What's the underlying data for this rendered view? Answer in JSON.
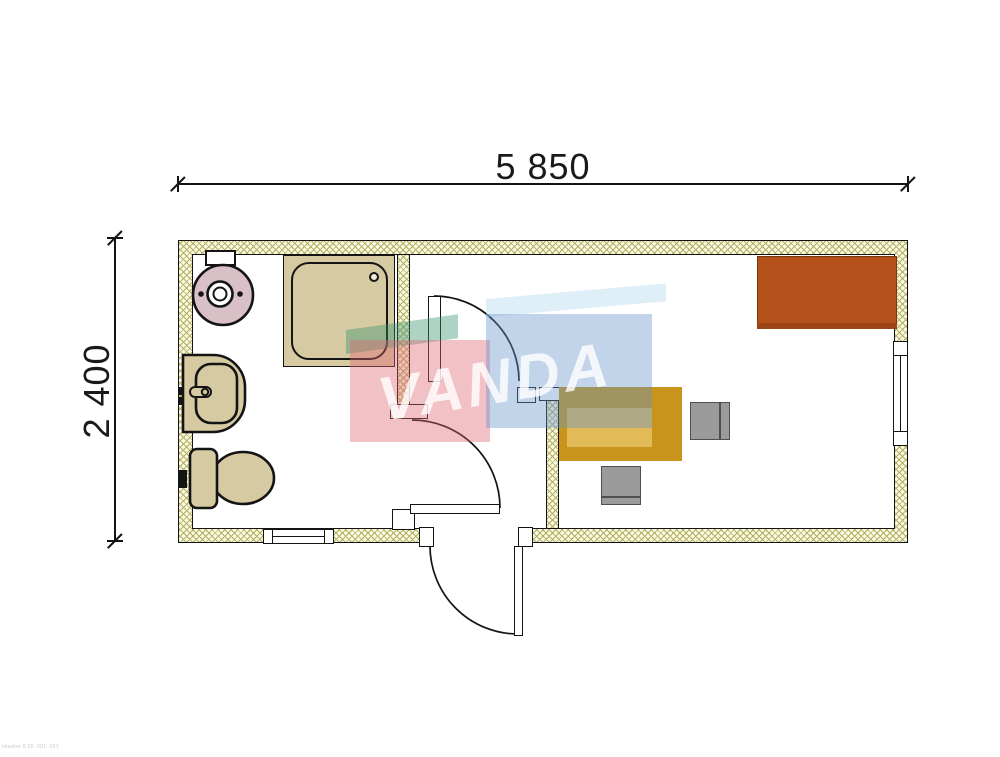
{
  "drawing": {
    "top_dimension": "5 850",
    "left_dimension": "2 400"
  },
  "watermark": {
    "text": "VANDA"
  },
  "footer": {
    "note": "shadow 0,55 .001 .001"
  },
  "colors": {
    "outline": "#141414",
    "dim_text": "#1a1a1a",
    "wall_fill": "#faf9e6",
    "wall_hatch": "#b3b060",
    "fixture_tan": "#d6caa2",
    "boiler_pink": "#d9bfc6",
    "desk_gold": "#c8941c",
    "desk_gold_light": "#e2ba58",
    "chair_gray": "#9b9b9b",
    "chair_line": "#4f4f4f",
    "cabinet_rust": "#b5521b",
    "cabinet_rust_dark": "#9c4416",
    "wm_pink": "rgba(222,100,112,0.40)",
    "wm_teal": "rgba(52,145,108,0.40)",
    "wm_blue": "rgba(100,148,202,0.40)",
    "wm_pale": "rgba(185,220,238,0.45)",
    "wm_text": "rgba(255,255,255,0.80)"
  }
}
